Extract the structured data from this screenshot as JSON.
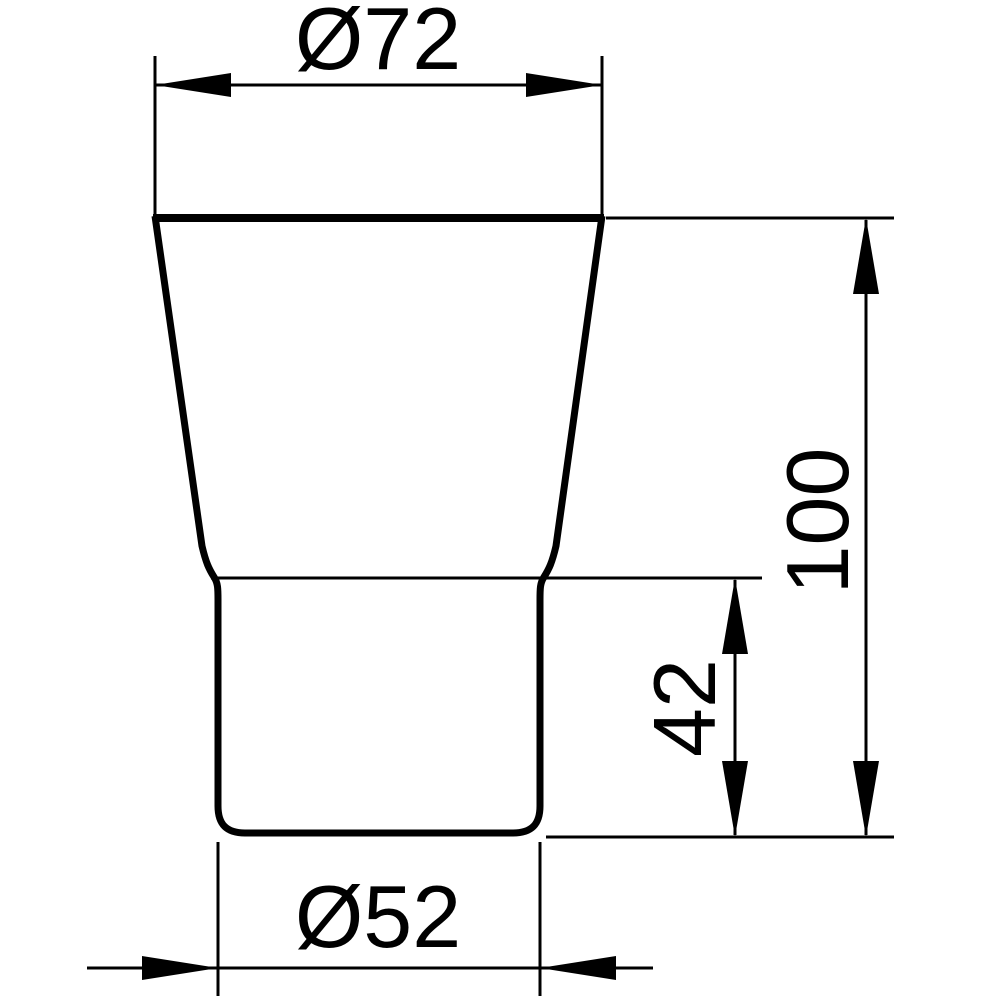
{
  "colors": {
    "ink": "#000000",
    "background": "#ffffff"
  },
  "figure": {
    "kind": "dimensioned-technical-drawing",
    "shape": "tumbler-profile-outline"
  },
  "dimensions": {
    "top_diameter": {
      "label": "Ø72",
      "value": 72,
      "kind": "diameter",
      "orientation": "horizontal",
      "position": "top"
    },
    "overall_height": {
      "label": "100",
      "value": 100,
      "kind": "linear",
      "orientation": "vertical",
      "position": "right"
    },
    "lower_section_height": {
      "label": "42",
      "value": 42,
      "kind": "linear",
      "orientation": "vertical",
      "position": "right-inner"
    },
    "base_diameter": {
      "label": "Ø52",
      "value": 52,
      "kind": "diameter",
      "orientation": "horizontal",
      "position": "bottom"
    }
  }
}
